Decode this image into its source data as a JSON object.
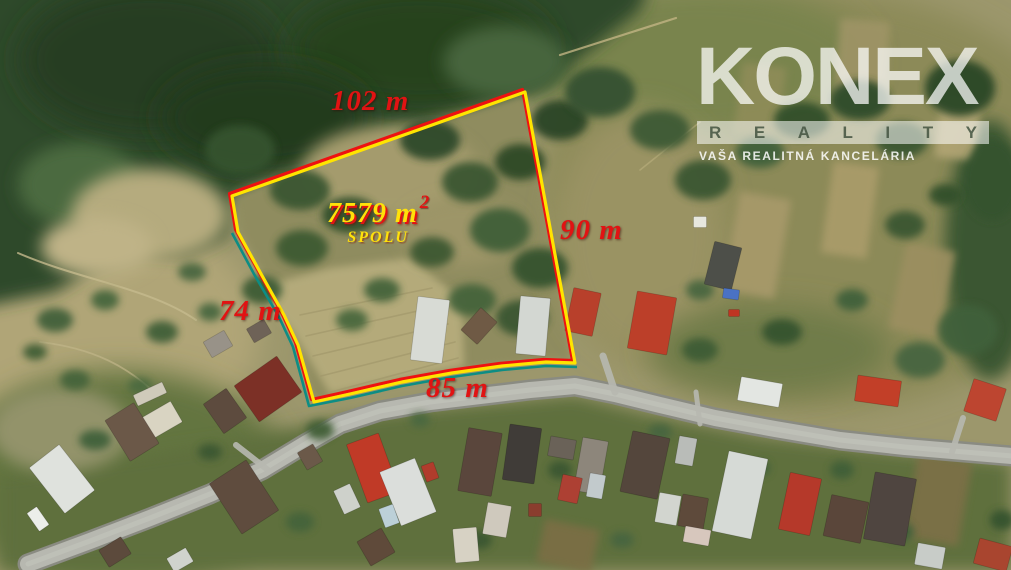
{
  "labels": {
    "top": "102 m",
    "right": "90 m",
    "left": "74 m",
    "bottom": "85 m",
    "area_value": "7579 m",
    "area_sup": "2",
    "area_total": "SPOLU"
  },
  "watermark": {
    "brand": "KONEX",
    "division": "REALITY",
    "tagline": "VAŠA REALITNÁ KANCELÁRIA"
  },
  "colors": {
    "label_red": "#e11313",
    "label_yellow": "#ffe10a",
    "boundary_yellow": "#ffe400",
    "boundary_red": "#ee1111",
    "boundary_teal": "#0d8d84",
    "logo_white": "rgba(255,255,255,0.72)",
    "logo_bar": "rgba(255,255,255,0.55)",
    "logo_letter": "#435340",
    "tagline_white": "rgba(255,255,255,0.85)"
  },
  "scene": {
    "base": "#9c976c",
    "regions": [
      {
        "e": [
          820,
          200,
          280,
          210
        ],
        "f": "#8c8a59",
        "b": 14
      },
      {
        "e": [
          90,
          330,
          170,
          120
        ],
        "f": "#b0a577",
        "b": 14
      },
      {
        "e": [
          120,
          480,
          170,
          110
        ],
        "f": "#64753f",
        "b": 14
      },
      {
        "p": "0,475 240,440 330,420 430,408 520,400 575,395 640,412 760,436 900,452 1011,462 1011,570 0,570",
        "f": "#5e6f3e",
        "b": 8
      },
      {
        "e": [
          700,
          60,
          170,
          75
        ],
        "f": "#79844e",
        "b": 14
      },
      {
        "p": "-20,-20 650,-20 640,10 590,50 545,85 470,106 420,122 350,142 290,166 232,196 228,236 185,256 140,252 95,267 55,292 -20,307",
        "f": "#2e4a2b",
        "b": 8
      },
      {
        "e": [
          150,
          60,
          130,
          75
        ],
        "f": "#253e21",
        "b": 14
      },
      {
        "e": [
          420,
          48,
          130,
          60
        ],
        "f": "#27421f",
        "b": 14
      },
      {
        "e": [
          265,
          118,
          105,
          52
        ],
        "f": "#223a1d",
        "b": 14
      },
      {
        "e": [
          80,
          185,
          62,
          42
        ],
        "f": "#4c6b3f",
        "b": 8
      },
      {
        "e": [
          505,
          62,
          62,
          36
        ],
        "f": "#46653c",
        "b": 8
      },
      {
        "e": [
          150,
          215,
          78,
          46
        ],
        "f": "#b5ab7e",
        "b": 8
      },
      {
        "e": [
          97,
          247,
          56,
          30
        ],
        "f": "#bfb387",
        "b": 8
      },
      {
        "p": "525,95 236,198 241,232 262,272 290,318 315,400 350,392 402,380 452,371 502,364 546,360 572,360",
        "f": "#8f8c5e",
        "b": 4
      },
      {
        "p": "255,288 330,268 410,258 462,300 464,366 330,394 293,332",
        "f": "#b4aa7a",
        "b": 4
      },
      {
        "e": [
          390,
          172,
          88,
          46
        ],
        "f": "#a49b6d",
        "b": 8
      },
      {
        "e": [
          462,
          232,
          60,
          34
        ],
        "f": "#9d9567",
        "b": 8
      },
      {
        "e": [
          640,
          235,
          85,
          125
        ],
        "f": "#9a9364",
        "b": 14
      },
      {
        "e": [
          990,
          250,
          45,
          130
        ],
        "f": "#3a5733",
        "b": 8
      },
      {
        "e": [
          60,
          430,
          70,
          42
        ],
        "f": "#93936a",
        "b": 8
      },
      {
        "e": [
          770,
          350,
          120,
          45
        ],
        "f": "#6f7c49",
        "b": 14
      }
    ],
    "plots": [
      [
        757,
        245,
        52,
        100,
        10,
        "#a89a6b"
      ],
      [
        850,
        210,
        46,
        92,
        8,
        "#ab9c6a"
      ],
      [
        922,
        290,
        50,
        88,
        12,
        "#9c8f60"
      ],
      [
        958,
        128,
        40,
        62,
        6,
        "#b2a575"
      ],
      [
        568,
        546,
        56,
        44,
        12,
        "#7c6e45"
      ],
      [
        938,
        500,
        55,
        85,
        10,
        "#7d6f46"
      ],
      [
        862,
        60,
        50,
        80,
        5,
        "#9f9466"
      ],
      [
        760,
        100,
        44,
        70,
        8,
        "#8f8c58"
      ]
    ],
    "tracks": [
      {
        "d": "M18,253 C 80,280 150,288 196,320",
        "s": "#c6ba8d",
        "w": 2,
        "o": 0.8
      },
      {
        "d": "M40,342 C 92,348 128,366 158,396",
        "s": "#c1b589",
        "w": 1.8,
        "o": 0.7
      },
      {
        "d": "M560,55 L676,18",
        "s": "#c2b483",
        "w": 2.2,
        "o": 0.8
      },
      {
        "d": "M640,170 L700,122",
        "s": "#bdb07e",
        "w": 1.6,
        "o": 0.6
      },
      {
        "d": "M300,315 L432,288",
        "s": "#a1976b",
        "w": 1.6,
        "o": 0.7
      },
      {
        "d": "M306,336 L440,306",
        "s": "#a1976b",
        "w": 1.6,
        "o": 0.7
      },
      {
        "d": "M313,356 L448,324",
        "s": "#a1976b",
        "w": 1.6,
        "o": 0.7
      },
      {
        "d": "M321,376 L455,342",
        "s": "#a1976b",
        "w": 1.6,
        "o": 0.7
      },
      {
        "d": "M331,392 L458,358",
        "s": "#a1976b",
        "w": 1.6,
        "o": 0.7
      }
    ],
    "road": {
      "d": "M28,564 L90,541 L150,518 L210,494 L262,470 L305,444 L340,424 L380,411 L430,402 L480,396 L530,390 L575,386 L615,394 L660,405 L715,418 L775,429 L840,440 L905,447 L1012,456",
      "casing": "#8a8b82",
      "fill": "#b7b8b0",
      "hi": "#c8c9c0",
      "w": 16,
      "cw": 21
    },
    "lanes": [
      {
        "d": "M615,392 L603,356",
        "w": 7
      },
      {
        "d": "M952,452 L963,418",
        "w": 6
      },
      {
        "d": "M268,470 L236,445",
        "w": 6
      },
      {
        "d": "M700,424 L696,392",
        "w": 5
      }
    ],
    "trees": [
      [
        240,
        150,
        35,
        25,
        "#35522e"
      ],
      [
        300,
        190,
        30,
        20,
        "#3a5631"
      ],
      [
        350,
        215,
        28,
        18,
        "#33502c"
      ],
      [
        302,
        248,
        26,
        18,
        "#3c5a33"
      ],
      [
        262,
        290,
        20,
        14,
        "#3e5c35"
      ],
      [
        430,
        140,
        30,
        20,
        "#2f4a29"
      ],
      [
        470,
        182,
        28,
        20,
        "#3a5733"
      ],
      [
        520,
        162,
        25,
        18,
        "#2d4827"
      ],
      [
        500,
        230,
        30,
        22,
        "#415f37"
      ],
      [
        540,
        268,
        28,
        20,
        "#35522d"
      ],
      [
        522,
        318,
        26,
        18,
        "#3a5732"
      ],
      [
        472,
        300,
        24,
        16,
        "#44633a"
      ],
      [
        432,
        252,
        22,
        15,
        "#3c5933"
      ],
      [
        382,
        290,
        18,
        12,
        "#44633a"
      ],
      [
        352,
        320,
        16,
        11,
        "#4a683c"
      ],
      [
        560,
        120,
        28,
        20,
        "#2b4526"
      ],
      [
        600,
        92,
        35,
        25,
        "#355130"
      ],
      [
        660,
        130,
        30,
        20,
        "#3d5a34"
      ],
      [
        703,
        180,
        28,
        20,
        "#3a5732"
      ],
      [
        760,
        152,
        24,
        16,
        "#41603a"
      ],
      [
        802,
        120,
        28,
        18,
        "#33502c"
      ],
      [
        860,
        100,
        30,
        20,
        "#2f4b29"
      ],
      [
        902,
        140,
        26,
        18,
        "#3a5733"
      ],
      [
        960,
        88,
        35,
        28,
        "#2c4627"
      ],
      [
        992,
        180,
        28,
        40,
        "#35522e"
      ],
      [
        968,
        330,
        30,
        25,
        "#41603a"
      ],
      [
        920,
        360,
        25,
        18,
        "#476540"
      ],
      [
        905,
        225,
        20,
        14,
        "#3a5733"
      ],
      [
        945,
        195,
        16,
        11,
        "#33502c"
      ],
      [
        55,
        320,
        18,
        12,
        "#42613a"
      ],
      [
        105,
        300,
        14,
        10,
        "#47663d"
      ],
      [
        162,
        332,
        16,
        11,
        "#3f5e37"
      ],
      [
        210,
        312,
        12,
        9,
        "#4a683f"
      ],
      [
        75,
        380,
        15,
        10,
        "#44633b"
      ],
      [
        140,
        386,
        12,
        8,
        "#4c6a40"
      ],
      [
        35,
        352,
        12,
        8,
        "#3f5d36"
      ],
      [
        192,
        272,
        14,
        9,
        "#486640"
      ],
      [
        320,
        430,
        14,
        10,
        "#3f5d36"
      ],
      [
        95,
        440,
        16,
        10,
        "#41603a"
      ],
      [
        560,
        470,
        12,
        9,
        "#3a5732"
      ],
      [
        760,
        468,
        10,
        8,
        "#41603a"
      ],
      [
        660,
        432,
        12,
        8,
        "#476540"
      ],
      [
        842,
        470,
        12,
        9,
        "#3f5e37"
      ],
      [
        300,
        522,
        14,
        10,
        "#44633b"
      ],
      [
        480,
        540,
        12,
        9,
        "#3a5732"
      ],
      [
        900,
        532,
        14,
        10,
        "#41603a"
      ],
      [
        622,
        540,
        12,
        8,
        "#476540"
      ],
      [
        1002,
        520,
        12,
        10,
        "#35522e"
      ],
      [
        420,
        420,
        10,
        7,
        "#4a683f"
      ],
      [
        210,
        452,
        12,
        8,
        "#3a5732"
      ],
      [
        700,
        350,
        18,
        12,
        "#3d5b34"
      ],
      [
        782,
        332,
        20,
        13,
        "#36532f"
      ],
      [
        852,
        300,
        16,
        11,
        "#41603a"
      ],
      [
        700,
        290,
        14,
        10,
        "#486640"
      ]
    ],
    "houses": [
      [
        430,
        330,
        32,
        64,
        7,
        "#d8dbd5"
      ],
      [
        533,
        326,
        30,
        58,
        5,
        "#d3d7d2"
      ],
      [
        479,
        326,
        22,
        30,
        42,
        "#6f5a45"
      ],
      [
        583,
        312,
        28,
        44,
        12,
        "#b8402b"
      ],
      [
        652,
        323,
        40,
        58,
        10,
        "#bc3f29"
      ],
      [
        723,
        266,
        28,
        44,
        14,
        "#4d4f49"
      ],
      [
        700,
        222,
        13,
        11,
        0,
        "#e7e7df"
      ],
      [
        731,
        294,
        16,
        10,
        8,
        "#4a72c4"
      ],
      [
        734,
        313,
        11,
        7,
        0,
        "#bf3422"
      ],
      [
        760,
        392,
        42,
        24,
        10,
        "#e3e6e2"
      ],
      [
        878,
        391,
        44,
        26,
        8,
        "#c23f28"
      ],
      [
        985,
        400,
        34,
        34,
        18,
        "#bd4530"
      ],
      [
        268,
        389,
        52,
        44,
        -35,
        "#7c3026"
      ],
      [
        225,
        411,
        28,
        36,
        -35,
        "#5d4b3e"
      ],
      [
        160,
        421,
        38,
        24,
        -30,
        "#d9d4c2"
      ],
      [
        132,
        432,
        34,
        48,
        -32,
        "#6b5848"
      ],
      [
        62,
        479,
        38,
        58,
        -38,
        "#dfe2dd"
      ],
      [
        38,
        519,
        12,
        22,
        -35,
        "#eceeea"
      ],
      [
        244,
        497,
        44,
        60,
        -33,
        "#5f4c3e"
      ],
      [
        310,
        457,
        18,
        20,
        -30,
        "#6b5949"
      ],
      [
        218,
        344,
        24,
        18,
        -30,
        "#989288"
      ],
      [
        259,
        331,
        20,
        16,
        -30,
        "#6e6257"
      ],
      [
        150,
        394,
        32,
        12,
        -25,
        "#cfcaba"
      ],
      [
        115,
        552,
        26,
        20,
        -32,
        "#5c4a3c"
      ],
      [
        180,
        560,
        22,
        16,
        -30,
        "#d0d3cd"
      ],
      [
        376,
        547,
        28,
        28,
        -30,
        "#5f4a3a"
      ],
      [
        373,
        468,
        34,
        62,
        -20,
        "#c03a27"
      ],
      [
        408,
        492,
        38,
        58,
        -22,
        "#dbdedb"
      ],
      [
        347,
        499,
        18,
        26,
        -25,
        "#ced1cb"
      ],
      [
        430,
        472,
        13,
        17,
        -20,
        "#b03c2c"
      ],
      [
        389,
        516,
        15,
        20,
        -20,
        "#bcd0d8"
      ],
      [
        480,
        462,
        34,
        64,
        10,
        "#5a463c"
      ],
      [
        522,
        454,
        32,
        56,
        8,
        "#403c38"
      ],
      [
        562,
        448,
        26,
        20,
        10,
        "#6a6258"
      ],
      [
        591,
        466,
        26,
        54,
        10,
        "#8d867b"
      ],
      [
        570,
        489,
        20,
        26,
        12,
        "#ad4033"
      ],
      [
        596,
        486,
        16,
        24,
        10,
        "#c2cacc"
      ],
      [
        535,
        510,
        13,
        13,
        0,
        "#8a3d2e"
      ],
      [
        497,
        520,
        24,
        32,
        10,
        "#cfc9bd"
      ],
      [
        466,
        545,
        24,
        34,
        -5,
        "#d7d2c4"
      ],
      [
        645,
        465,
        38,
        62,
        12,
        "#54463c"
      ],
      [
        686,
        451,
        18,
        28,
        10,
        "#b9bcb8"
      ],
      [
        740,
        495,
        40,
        82,
        12,
        "#d6dad6"
      ],
      [
        693,
        512,
        26,
        32,
        10,
        "#5e4a3b"
      ],
      [
        668,
        509,
        22,
        30,
        10,
        "#d2d5cf"
      ],
      [
        697,
        536,
        26,
        16,
        10,
        "#d7c7bd"
      ],
      [
        800,
        504,
        32,
        58,
        12,
        "#b5392a"
      ],
      [
        846,
        519,
        38,
        42,
        12,
        "#5a463a"
      ],
      [
        890,
        509,
        42,
        68,
        10,
        "#4f4540"
      ],
      [
        993,
        555,
        34,
        26,
        15,
        "#a9452f"
      ],
      [
        930,
        556,
        28,
        22,
        10,
        "#c8ccc8"
      ]
    ],
    "parcel": {
      "d": "M525,92 L232,196 L238,232 L260,272 L284,315 L298,345 L314,402 L350,394 L402,382 L452,373 L502,366 L546,362 L575,363 Z",
      "teal_d": "M232,233 L254,274 L279,317 L293,347 L309,406 L350,398 L402,386 L452,377 L502,370 L546,366 L577,367",
      "red_offset": "-2.5,-2.5",
      "w": 3.2
    }
  }
}
